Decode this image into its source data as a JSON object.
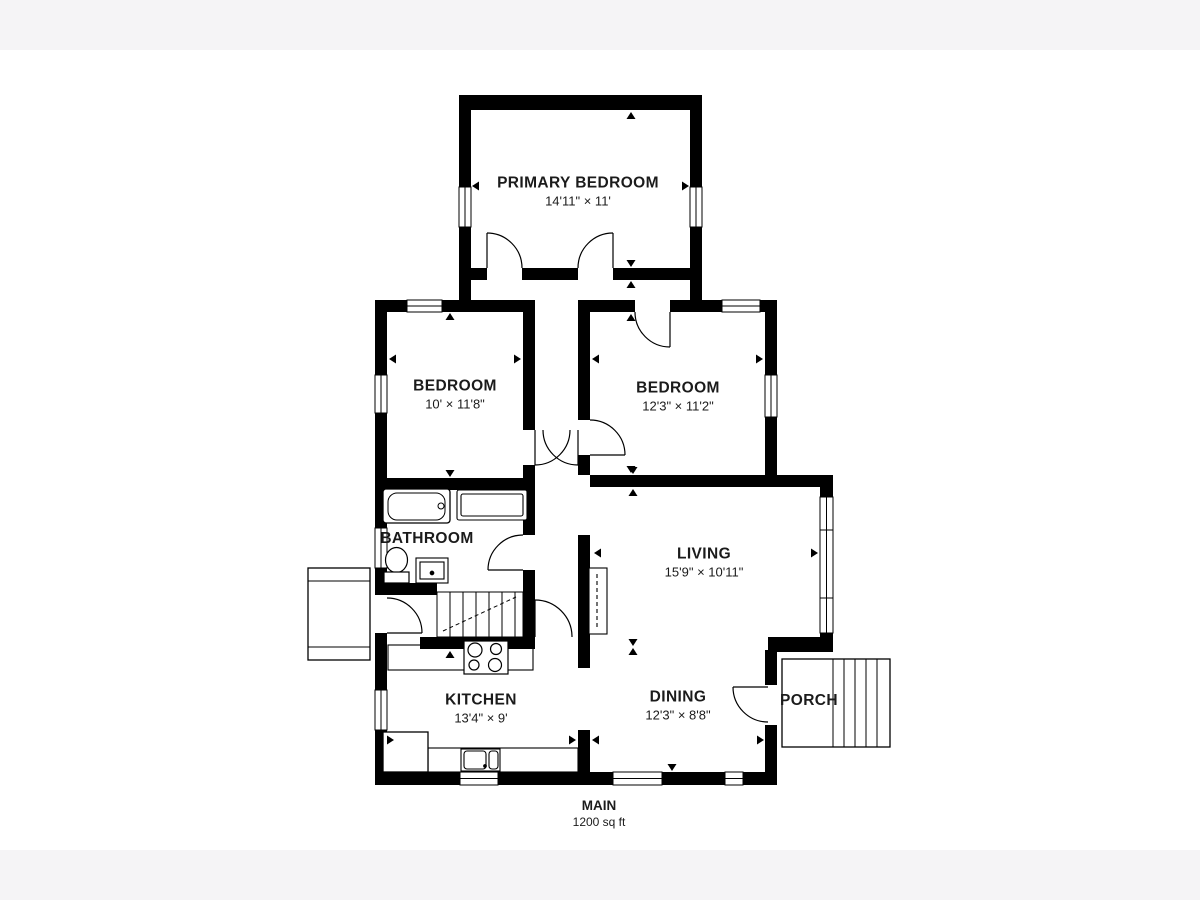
{
  "floor": {
    "name": "MAIN",
    "area": "1200 sq ft"
  },
  "rooms": [
    {
      "id": "primary-bedroom",
      "name": "PRIMARY BEDROOM",
      "dims": "14'11\" × 11'"
    },
    {
      "id": "bedroom-left",
      "name": "BEDROOM",
      "dims": "10' × 11'8\""
    },
    {
      "id": "bedroom-right",
      "name": "BEDROOM",
      "dims": "12'3\" × 11'2\""
    },
    {
      "id": "bathroom",
      "name": "BATHROOM",
      "dims": ""
    },
    {
      "id": "living",
      "name": "LIVING",
      "dims": "15'9\" × 10'11\""
    },
    {
      "id": "kitchen",
      "name": "KITCHEN",
      "dims": "13'4\" × 9'"
    },
    {
      "id": "dining",
      "name": "DINING",
      "dims": "12'3\" × 8'8\""
    },
    {
      "id": "porch",
      "name": "PORCH",
      "dims": ""
    }
  ],
  "fixtures": [
    "bathtub",
    "toilet",
    "vanity-sink",
    "closet",
    "staircase",
    "side-landing",
    "fireplace",
    "stove",
    "kitchen-counter",
    "kitchen-sink",
    "refrigerator",
    "porch-steps"
  ],
  "colors": {
    "walls": "#000000",
    "background": "#ffffff",
    "margin_band": "#f5f4f6",
    "text": "#1b1b1b"
  }
}
